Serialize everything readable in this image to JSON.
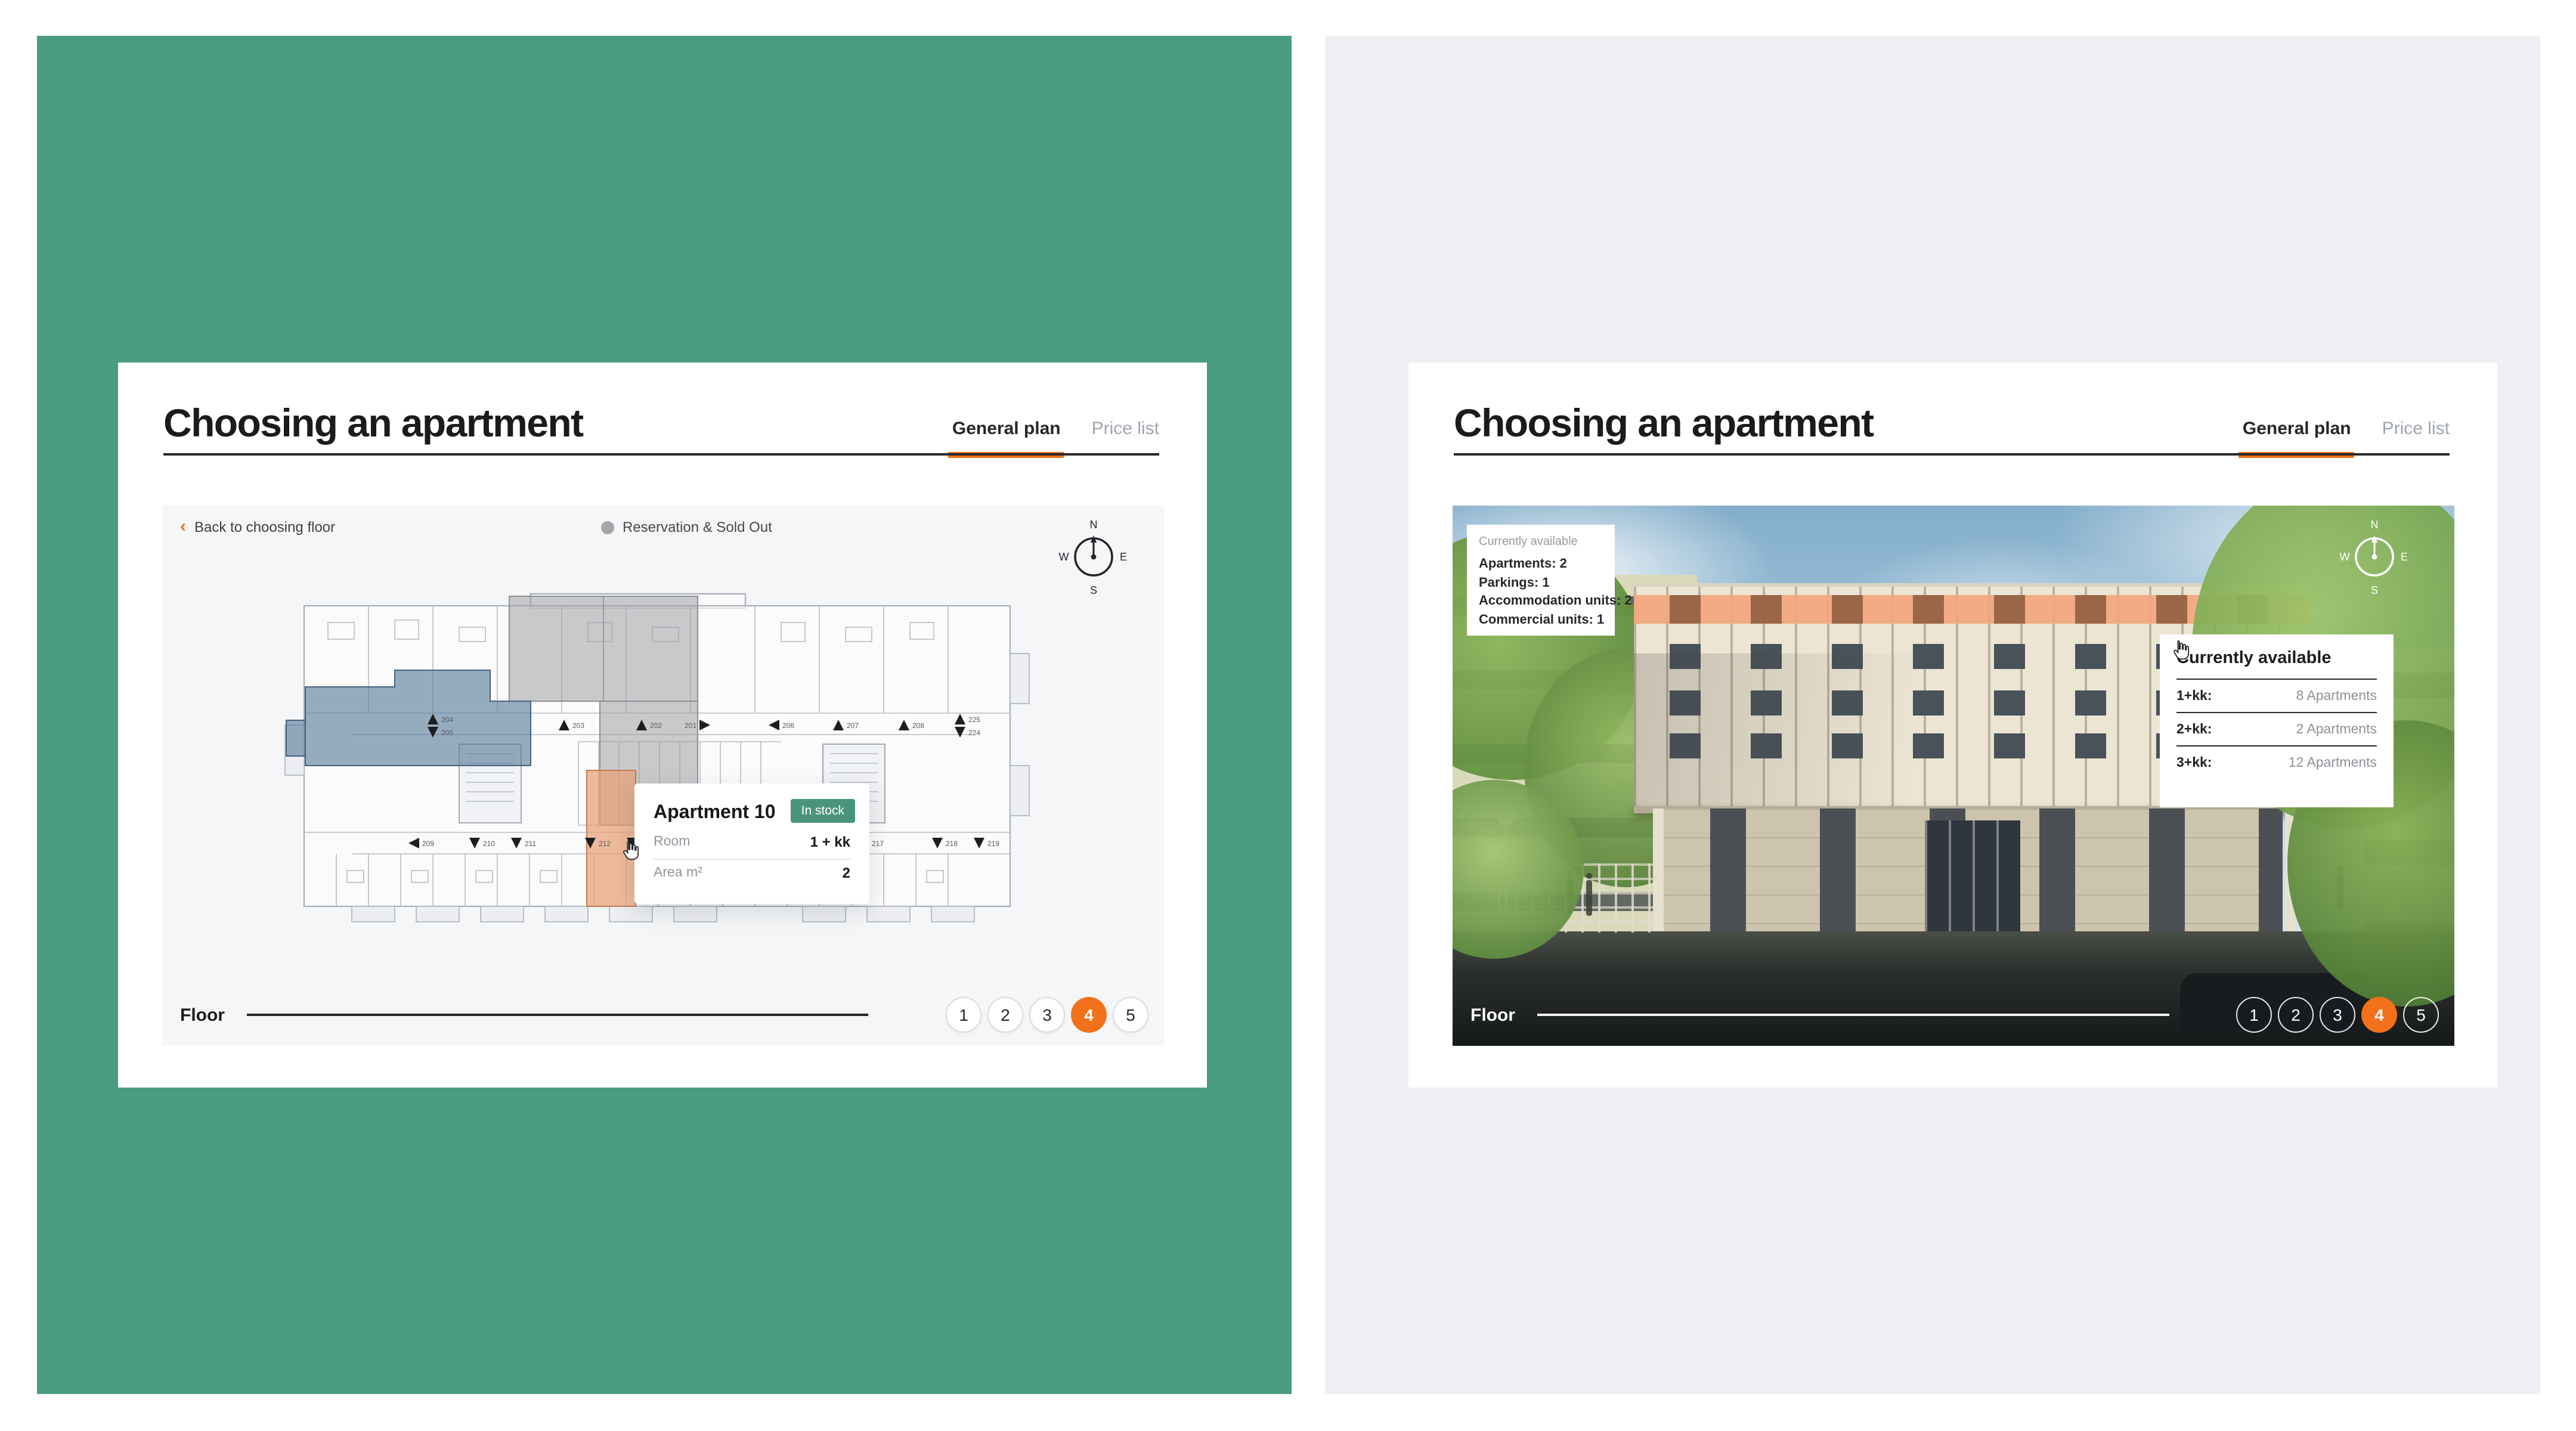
{
  "app": {
    "accent": "#f4711b",
    "badge_green": "#4a9579"
  },
  "left_panel": {
    "background": "#4a9d80",
    "title": "Choosing an apartment",
    "tabs": {
      "general_plan": "General plan",
      "price_list": "Price list"
    },
    "back_link": "Back to choosing floor",
    "legend": "Reservation & Sold Out",
    "compass": {
      "n": "N",
      "e": "E",
      "s": "S",
      "w": "W"
    },
    "popup": {
      "title": "Apartment 10",
      "badge": "In stock",
      "room_label": "Room",
      "room_value": "1 + kk",
      "area_label": "Area m²",
      "area_value": "2"
    },
    "floor": {
      "label": "Floor",
      "options": [
        "1",
        "2",
        "3",
        "4",
        "5"
      ],
      "active": "4"
    },
    "plan": {
      "highlight_colors": {
        "available_hover": "#e8a076",
        "selected": "#557a99",
        "sold": "#9ea0a3"
      },
      "markers_top": [
        "204",
        "205",
        "203",
        "202",
        "201",
        "206",
        "207",
        "208",
        "225",
        "224"
      ],
      "markers_bottom": [
        "209",
        "210",
        "211",
        "212",
        "213",
        "214",
        "215",
        "216",
        "217",
        "218",
        "219"
      ]
    }
  },
  "right_panel": {
    "background": "#edeff3",
    "title": "Choosing an apartment",
    "tabs": {
      "general_plan": "General plan",
      "price_list": "Price list"
    },
    "summary": {
      "label": "Currently available",
      "items": [
        "Apartments: 2",
        "Parkings: 1",
        "Accommodation units: 2",
        "Commercial units: 1"
      ]
    },
    "availability": {
      "title": "Currently available",
      "rows": [
        {
          "label": "1+kk:",
          "value": "8 Apartments"
        },
        {
          "label": "2+kk:",
          "value": "2 Apartments"
        },
        {
          "label": "3+kk:",
          "value": "12 Apartments"
        }
      ]
    },
    "floor": {
      "label": "Floor",
      "options": [
        "1",
        "2",
        "3",
        "4",
        "5"
      ],
      "active": "4"
    },
    "compass": {
      "n": "N",
      "e": "E",
      "s": "S",
      "w": "W"
    }
  }
}
